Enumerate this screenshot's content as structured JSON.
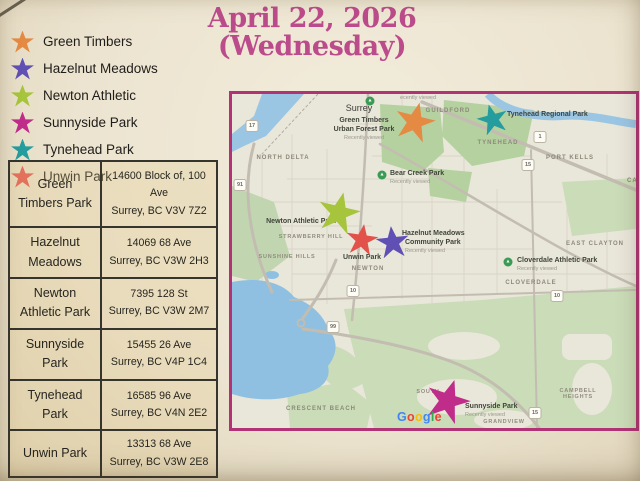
{
  "title": {
    "line1": "April 22, 2026",
    "line2": "(Wednesday)",
    "color": "#bc4b8b"
  },
  "legend": {
    "items": [
      {
        "label": "Green Timbers",
        "color": "#e58a43"
      },
      {
        "label": "Hazelnut Meadows",
        "color": "#6150b4"
      },
      {
        "label": "Newton Athletic",
        "color": "#a6c43c"
      },
      {
        "label": "Sunnyside Park",
        "color": "#c02c8a"
      },
      {
        "label": "Tynehead Park",
        "color": "#259c9e"
      },
      {
        "label": "Unwin Park",
        "color": "#e2514a"
      }
    ]
  },
  "table": {
    "rows": [
      {
        "park": "Green Timbers Park",
        "address1": "14600 Block of, 100 Ave",
        "address2": "Surrey, BC V3V 7Z2"
      },
      {
        "park": "Hazelnut Meadows",
        "address1": "14069 68 Ave",
        "address2": "Surrey, BC V3W 2H3"
      },
      {
        "park": "Newton Athletic Park",
        "address1": "7395 128 St",
        "address2": "Surrey, BC V3W 2M7"
      },
      {
        "park": "Sunnyside Park",
        "address1": "15455 26 Ave",
        "address2": "Surrey, BC V4P 1C4"
      },
      {
        "park": "Tynehead Park",
        "address1": "16585 96 Ave",
        "address2": "Surrey, BC V4N 2E2"
      },
      {
        "park": "Unwin Park",
        "address1": "13313 68 Ave",
        "address2": "Surrey, BC V3W 2E8"
      }
    ]
  },
  "map": {
    "border_color": "#b13275",
    "watermark": "Google",
    "watermark_colors": [
      "#4285F4",
      "#EA4335",
      "#FBBC05",
      "#4285F4",
      "#34A853",
      "#EA4335"
    ],
    "watermark_pos": {
      "x": 165,
      "y": 316
    },
    "markers": [
      {
        "name": "green-timbers",
        "color": "#e58a43",
        "x": 183,
        "y": 27,
        "size": 40,
        "rot": 14
      },
      {
        "name": "tynehead",
        "color": "#259c9e",
        "x": 260,
        "y": 25,
        "size": 31,
        "rot": -15
      },
      {
        "name": "newton-athletic",
        "color": "#a6c43c",
        "x": 107,
        "y": 118,
        "size": 42,
        "rot": 13
      },
      {
        "name": "unwin",
        "color": "#e2514a",
        "x": 130,
        "y": 145,
        "size": 32,
        "rot": 8
      },
      {
        "name": "hazelnut-meadows",
        "color": "#6150b4",
        "x": 160,
        "y": 148,
        "size": 33,
        "rot": -6
      },
      {
        "name": "sunnyside",
        "color": "#c02c8a",
        "x": 216,
        "y": 306,
        "size": 44,
        "rot": 18
      }
    ],
    "labels": [
      {
        "text": "ecently viewed",
        "x": 186,
        "y": 1,
        "cls": "sub"
      },
      {
        "text": "Surrey",
        "x": 127,
        "y": 10,
        "cls": "city"
      },
      {
        "text": "GUILDFORD",
        "x": 216,
        "y": 14,
        "cls": "area"
      },
      {
        "text": "Green Timbers",
        "x": 132,
        "y": 23,
        "cls": "poi"
      },
      {
        "text": "Urban Forest Park",
        "x": 132,
        "y": 32,
        "cls": "poi"
      },
      {
        "text": "Recently viewed",
        "x": 132,
        "y": 41,
        "cls": "sub"
      },
      {
        "text": "Tynehead Regional Park",
        "x": 275,
        "y": 17,
        "cls": "poi",
        "align": "l"
      },
      {
        "text": "TYNEHEAD",
        "x": 266,
        "y": 46,
        "cls": "area"
      },
      {
        "text": "PORT KELLS",
        "x": 338,
        "y": 61,
        "cls": "area"
      },
      {
        "text": "CAR",
        "x": 395,
        "y": 84,
        "cls": "area",
        "align": "l"
      },
      {
        "text": "NORTH DELTA",
        "x": 51,
        "y": 61,
        "cls": "area"
      },
      {
        "text": "Bear Creek Park",
        "x": 158,
        "y": 76,
        "cls": "poi",
        "align": "l"
      },
      {
        "text": "Recently viewed",
        "x": 158,
        "y": 85,
        "cls": "sub",
        "align": "l"
      },
      {
        "text": "Newton Athletic Park",
        "x": 69,
        "y": 124,
        "cls": "poi"
      },
      {
        "text": "STRAWBERRY HILL",
        "x": 79,
        "y": 140,
        "cls": "areasm"
      },
      {
        "text": "SUNSHINE HILLS",
        "x": 55,
        "y": 160,
        "cls": "areasm"
      },
      {
        "text": "Unwin Park",
        "x": 130,
        "y": 160,
        "cls": "poi"
      },
      {
        "text": "NEWTON",
        "x": 136,
        "y": 172,
        "cls": "area"
      },
      {
        "text": "Hazelnut Meadows",
        "x": 170,
        "y": 136,
        "cls": "poi",
        "align": "l"
      },
      {
        "text": "Community Park",
        "x": 173,
        "y": 145,
        "cls": "poi",
        "align": "l"
      },
      {
        "text": "Recently viewed",
        "x": 173,
        "y": 154,
        "cls": "sub",
        "align": "l"
      },
      {
        "text": "EAST CLAYTON",
        "x": 363,
        "y": 147,
        "cls": "area"
      },
      {
        "text": "Cloverdale Athletic Park",
        "x": 285,
        "y": 163,
        "cls": "poi",
        "align": "l"
      },
      {
        "text": "Recently viewed",
        "x": 285,
        "y": 172,
        "cls": "sub",
        "align": "l"
      },
      {
        "text": "CLOVERDALE",
        "x": 299,
        "y": 186,
        "cls": "area"
      },
      {
        "text": "CRESCENT BEACH",
        "x": 89,
        "y": 312,
        "cls": "area"
      },
      {
        "text": "SOUTH",
        "x": 196,
        "y": 295,
        "cls": "areasm"
      },
      {
        "text": "CAMPBELL",
        "x": 346,
        "y": 294,
        "cls": "areasm"
      },
      {
        "text": "HEIGHTS",
        "x": 346,
        "y": 300,
        "cls": "areasm"
      },
      {
        "text": "GRANDVIEW",
        "x": 272,
        "y": 325,
        "cls": "areasm"
      },
      {
        "text": "Sunnyside Park",
        "x": 233,
        "y": 309,
        "cls": "poi",
        "align": "l"
      },
      {
        "text": "Recently viewed",
        "x": 233,
        "y": 318,
        "cls": "sub",
        "align": "l"
      }
    ],
    "shields": [
      {
        "n": "17",
        "x": 20,
        "y": 32
      },
      {
        "n": "91",
        "x": 8,
        "y": 91
      },
      {
        "n": "1",
        "x": 308,
        "y": 43
      },
      {
        "n": "15",
        "x": 296,
        "y": 71
      },
      {
        "n": "10",
        "x": 121,
        "y": 197
      },
      {
        "n": "10",
        "x": 325,
        "y": 202
      },
      {
        "n": "99",
        "x": 101,
        "y": 233
      },
      {
        "n": "15",
        "x": 303,
        "y": 319
      }
    ],
    "park_icons": [
      {
        "x": 138,
        "y": 7
      },
      {
        "x": 150,
        "y": 81
      },
      {
        "x": 276,
        "y": 168
      }
    ]
  }
}
